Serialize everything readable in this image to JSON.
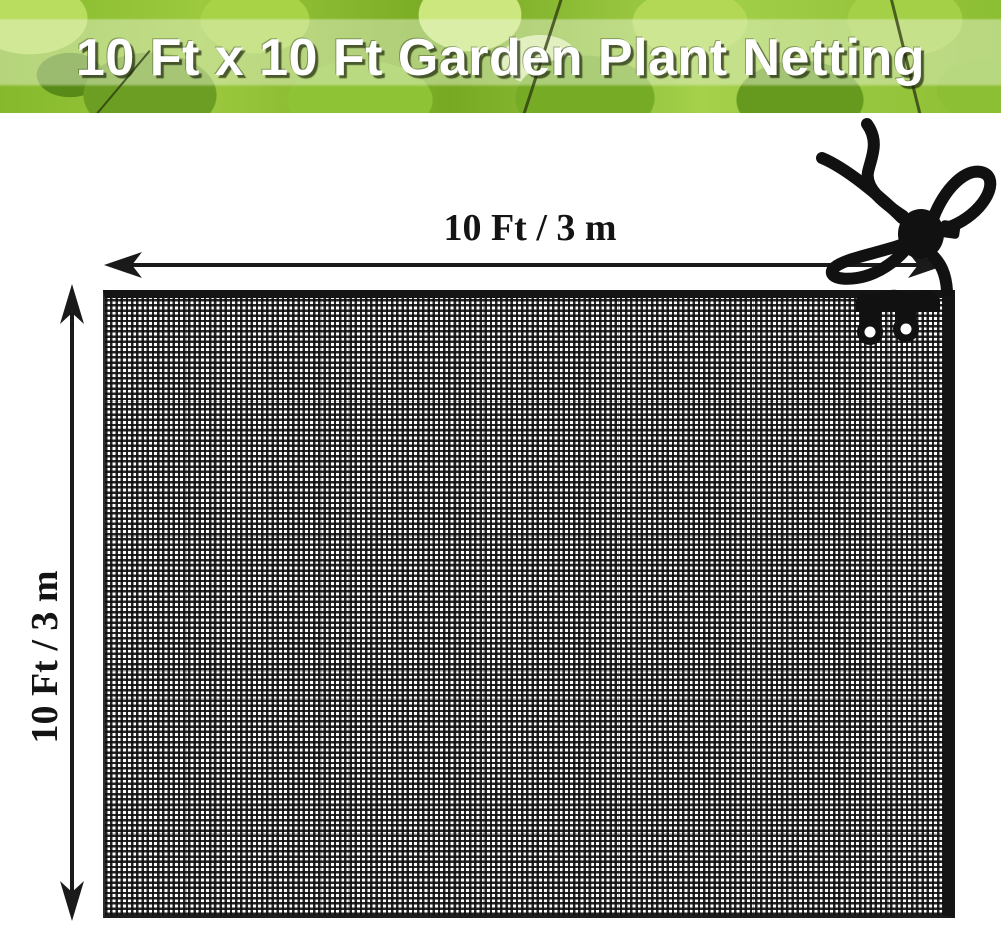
{
  "banner": {
    "title": "10 Ft x 10 Ft Garden Plant Netting",
    "title_color": "#ffffff",
    "background_theme": "green-leaves-photo"
  },
  "dimension_labels": {
    "width": "10 Ft / 3 m",
    "height": "10 Ft / 3 m"
  },
  "product": {
    "name": "garden plant netting panel",
    "mesh_color": "#141414",
    "background": "#ffffff",
    "accessories": [
      {
        "name": "drawstring-cord-bow",
        "color": "#111111"
      },
      {
        "name": "cord-lock-toggle",
        "color": "#111111"
      },
      {
        "name": "hook-clips",
        "color": "#111111"
      }
    ]
  },
  "colors": {
    "annotation_ink": "#1a1a1a",
    "banner_greens": [
      "#578a16",
      "#77a922",
      "#8fc336",
      "#a8d347",
      "#cbe77e",
      "#d9ecab"
    ]
  }
}
